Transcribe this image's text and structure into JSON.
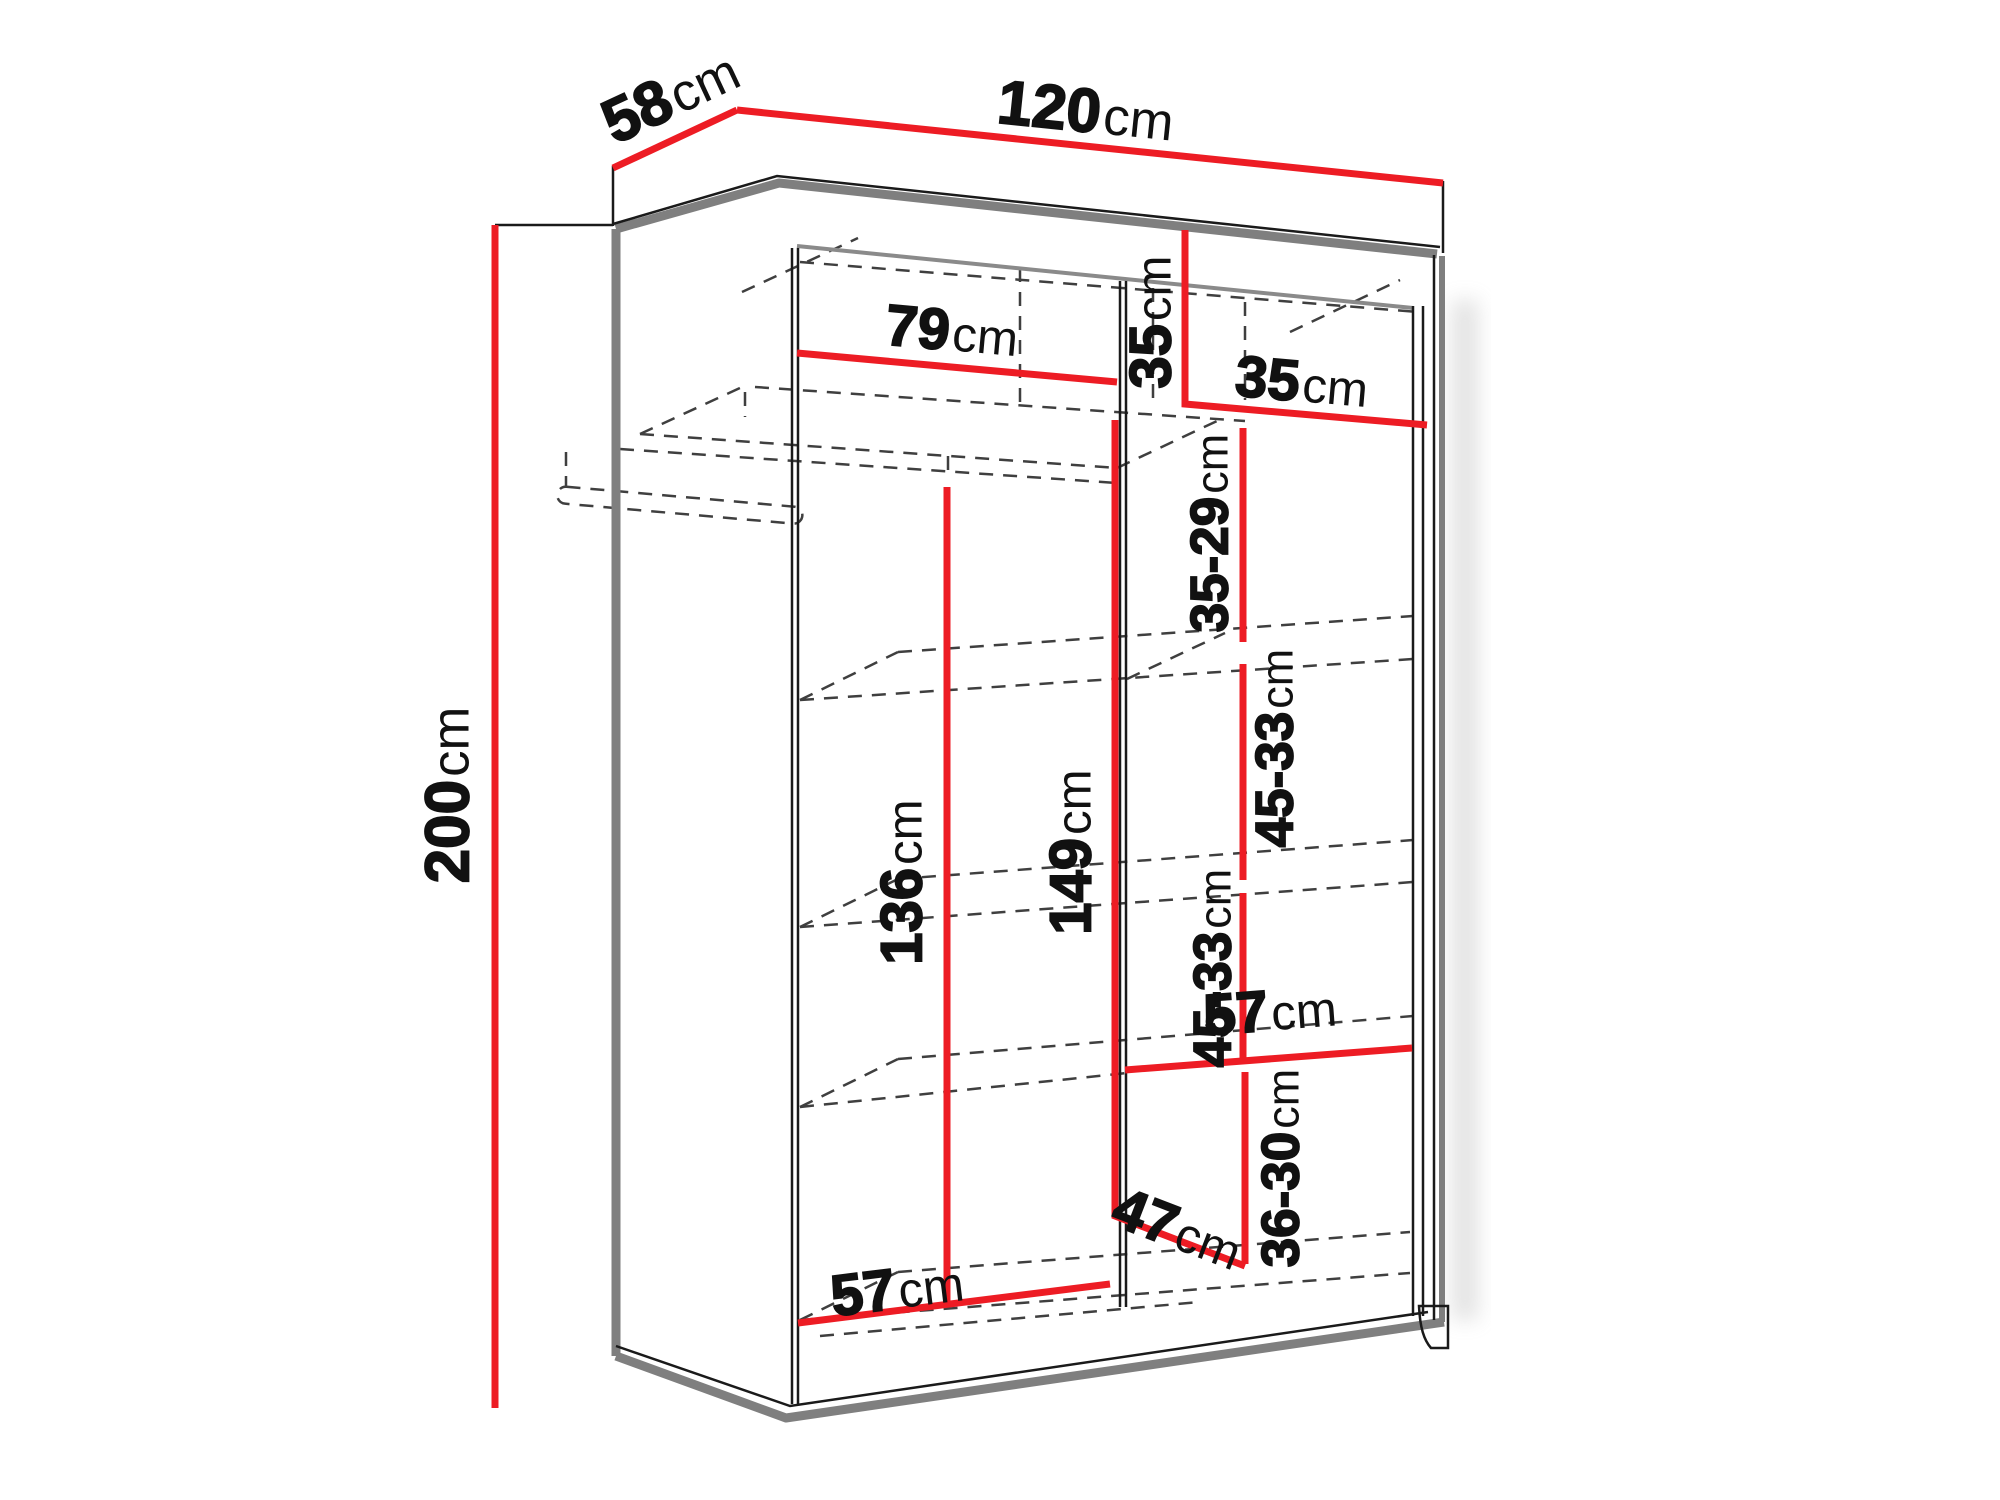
{
  "diagram": {
    "kind": "wardrobe-dimension-diagram",
    "unit": "cm",
    "colors": {
      "dimension_line": "#ed1c24",
      "edge_gray": "#7f7f7f",
      "outline_black": "#1a1a1a",
      "hidden_dashed": "#3f3f3f",
      "background": "#ffffff"
    },
    "overall": {
      "width_cm": 120,
      "depth_cm": 58,
      "height_cm": 200
    },
    "labels": {
      "depth": {
        "num": "58",
        "unit": "cm",
        "value": "58"
      },
      "width": {
        "num": "120",
        "unit": "cm",
        "value": "120"
      },
      "height": {
        "num": "200",
        "unit": "cm",
        "value": "200"
      },
      "top_shelf_width": {
        "num": "79",
        "unit": "cm",
        "value": "79"
      },
      "top_section_height": {
        "num": "35",
        "unit": "cm",
        "value": "35"
      },
      "top_section_width": {
        "num": "35",
        "unit": "cm",
        "value": "35"
      },
      "shelf_gap_top": {
        "num": "35-29",
        "unit": "cm",
        "value": "35-29"
      },
      "shelf_gap_upper": {
        "num": "45-33",
        "unit": "cm",
        "value": "45-33"
      },
      "hanging_height_left": {
        "num": "136",
        "unit": "cm",
        "value": "136"
      },
      "divider_height": {
        "num": "149",
        "unit": "cm",
        "value": "149"
      },
      "shelf_gap_lower": {
        "num": "45-33",
        "unit": "cm",
        "value": "45-33"
      },
      "shelf_width_right": {
        "num": "57",
        "unit": "cm",
        "value": "57"
      },
      "bottom_section_height": {
        "num": "36-30",
        "unit": "cm",
        "value": "36-30"
      },
      "bottom_depth_diagonal": {
        "num": "47",
        "unit": "cm",
        "value": "47"
      },
      "bottom_width_left": {
        "num": "57",
        "unit": "cm",
        "value": "57"
      }
    }
  }
}
